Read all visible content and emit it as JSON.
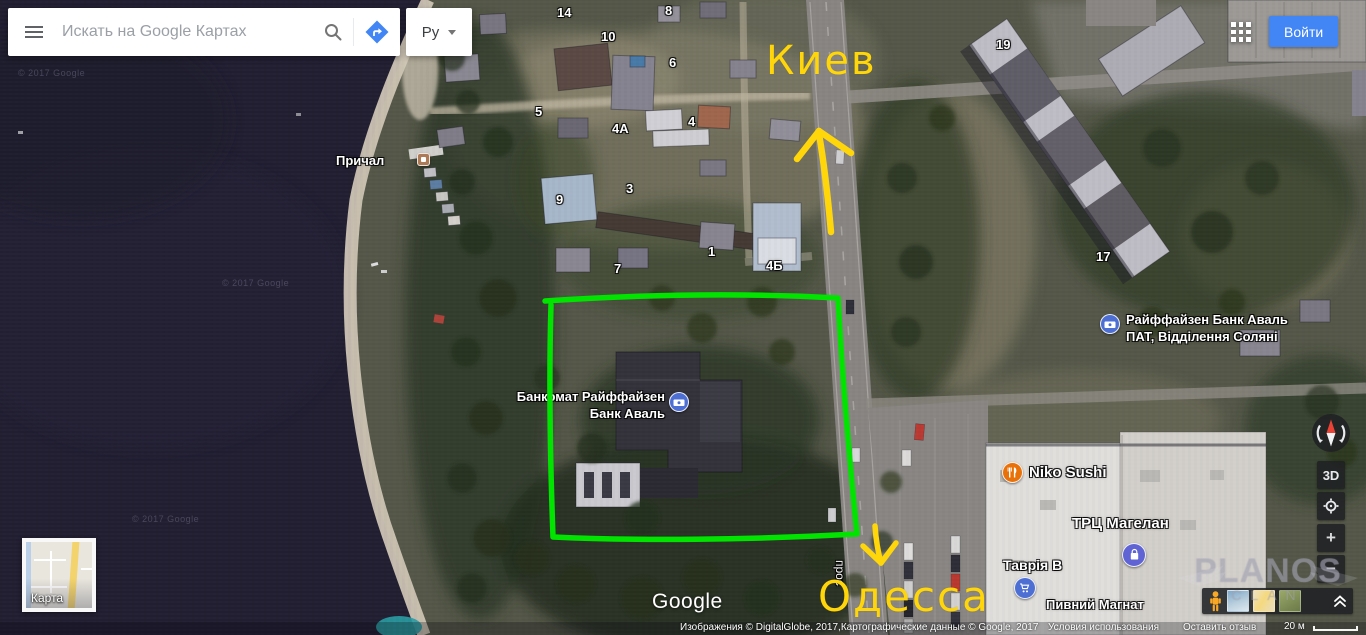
{
  "search_bar": {
    "placeholder": "Искать на Google Картах",
    "lang": "Ру"
  },
  "topbar": {
    "signin": "Войти"
  },
  "map": {
    "city_top": "Киев",
    "city_bottom": "Одесса",
    "labels": {
      "pier": "Причал",
      "atm_line1": "Банкомат Райффайзен",
      "atm_line2": "Банк Аваль",
      "bank_line1": "Райффайзен Банк Аваль",
      "bank_line2": "ПАТ, Відділення Соляні",
      "sushi": "Niko Sushi",
      "mall": "ТРЦ Магелан",
      "tavria": "Таврія В",
      "beer_shop": "Пивний Магнат",
      "street_vertical": "прос"
    },
    "house_numbers": [
      "14",
      "8",
      "10",
      "6",
      "5",
      "4А",
      "4",
      "9",
      "3",
      "1",
      "7",
      "4Б",
      "19",
      "17"
    ],
    "water_credits": [
      "© 2017 Google",
      "© 2017 Google",
      "© 2017 Google"
    ]
  },
  "minimap": {
    "label": "Карта"
  },
  "branding": {
    "logo": "Google"
  },
  "attribution": {
    "imagery": "Изображения © DigitalGlobe, 2017,Картографические данные © Google, 2017",
    "terms": "Условия использования",
    "feedback": "Оставить отзыв",
    "scale": "20 м"
  },
  "controls": {
    "three_d": "3D",
    "zoom_in": "+",
    "zoom_out": "−"
  },
  "watermark": {
    "name": "PLANOS",
    "sub": "CLAN"
  },
  "colors": {
    "annotation_yellow": "#ffd60a",
    "highlight_green": "#00e400",
    "signin_blue": "#4285f4",
    "water": "#211e31"
  }
}
